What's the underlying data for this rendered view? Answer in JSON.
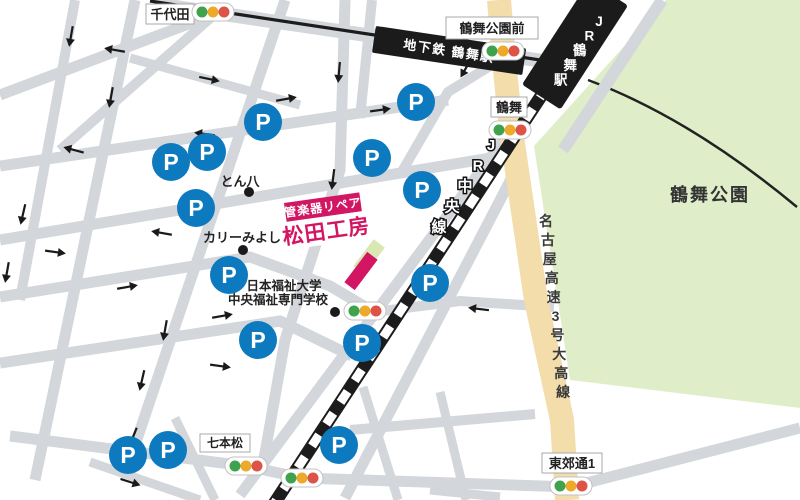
{
  "map": {
    "colors": {
      "road": "#d3d6da",
      "park_green": "#dfeec8",
      "expressway_beige": "#f2ddab",
      "rail_black": "#1c1c1c",
      "shop_pink": "#d31663",
      "building_green": "#d9e7b2",
      "parking_blue": "#0d7ac0",
      "signal_green": "#3fa24c",
      "signal_yellow": "#edaa2a",
      "signal_red": "#dd5347"
    },
    "park": {
      "label": "鶴舞公園"
    },
    "rail": {
      "subway_label": "地下鉄 鶴舞駅",
      "jr_station_label": "JR鶴舞駅",
      "jr_line_label": "JR中央線"
    },
    "expressway": {
      "label": "名古屋高速3号大高線"
    },
    "boxed_labels": [
      {
        "id": "chiyoda",
        "text": "千代田"
      },
      {
        "id": "tsurumai-koen-mae",
        "text": "鶴舞公園前"
      },
      {
        "id": "tsurumai",
        "text": "鶴舞"
      },
      {
        "id": "shichihonmatsu",
        "text": "七本松"
      },
      {
        "id": "tokodori-1",
        "text": "東郊通1"
      }
    ],
    "pois": [
      {
        "text": "とん八"
      },
      {
        "text": "カリーみよし"
      },
      {
        "text": "日本福祉大学"
      },
      {
        "text": "中央福祉専門学校"
      }
    ],
    "poi_dots": [
      [
        249,
        192
      ],
      [
        243,
        250
      ],
      [
        335,
        312
      ]
    ],
    "shop": {
      "tagline": "管楽器リペア",
      "name": "松田工房"
    },
    "parking": {
      "label": "P",
      "positions": [
        [
          171,
          162
        ],
        [
          207,
          152
        ],
        [
          196,
          208
        ],
        [
          229,
          275
        ],
        [
          263,
          122
        ],
        [
          416,
          102
        ],
        [
          372,
          158
        ],
        [
          422,
          190
        ],
        [
          258,
          340
        ],
        [
          430,
          283
        ],
        [
          362,
          343
        ],
        [
          339,
          445
        ],
        [
          128,
          455
        ],
        [
          168,
          450
        ]
      ]
    },
    "signals": {
      "positions": [
        [
          213,
          12
        ],
        [
          503,
          51
        ],
        [
          510,
          130
        ],
        [
          365,
          311
        ],
        [
          246,
          466
        ],
        [
          302,
          478
        ],
        [
          571,
          486
        ]
      ]
    },
    "arrows": {
      "positions": [
        [
          71,
          36,
          100
        ],
        [
          115,
          50,
          190
        ],
        [
          209,
          79,
          12
        ],
        [
          111,
          97,
          100
        ],
        [
          339,
          72,
          95
        ],
        [
          286,
          99,
          -10
        ],
        [
          380,
          110,
          -8
        ],
        [
          205,
          134,
          188
        ],
        [
          74,
          150,
          195
        ],
        [
          200,
          200,
          10
        ],
        [
          23,
          214,
          103
        ],
        [
          162,
          233,
          190
        ],
        [
          55,
          252,
          8
        ],
        [
          7,
          272,
          100
        ],
        [
          127,
          287,
          -10
        ],
        [
          222,
          316,
          -10
        ],
        [
          333,
          179,
          97
        ],
        [
          165,
          330,
          100
        ],
        [
          142,
          380,
          103
        ],
        [
          220,
          366,
          8
        ],
        [
          479,
          309,
          187
        ],
        [
          466,
          68,
          120
        ],
        [
          133,
          437,
          112
        ],
        [
          130,
          482,
          18
        ]
      ]
    }
  }
}
